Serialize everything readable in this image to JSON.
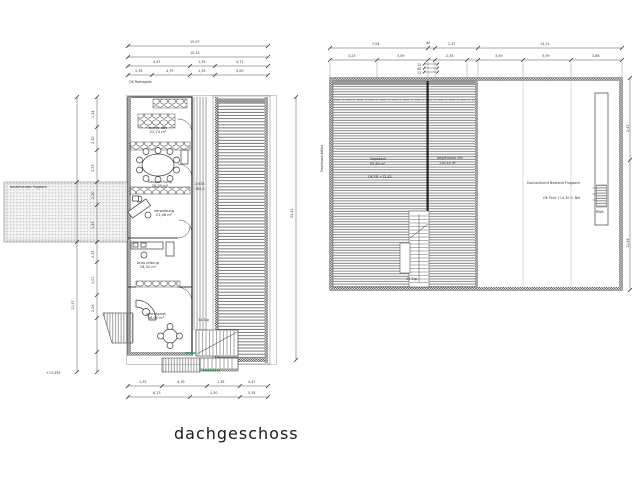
{
  "title": "dachgeschoss",
  "colors": {
    "accent_green": "#19a24a",
    "line": "#3c3c3c",
    "hatch": "#7a7a7a"
  },
  "left_plan": {
    "note_rollregal": "OK Rollregale",
    "terrace_label": "bestehendes flugdach",
    "elevation_note": "+13,455",
    "corridor_dim_a": "2,635",
    "corridor_dim_b": "100,5",
    "stair_label": "14 Stg",
    "rooms": [
      {
        "label": "archiv edv",
        "area": "22,74 m²"
      },
      {
        "label": "besprechung",
        "area": "28,05 m²"
      },
      {
        "label": "verwaltung",
        "area": "21,46 m²"
      },
      {
        "label": "büro leitung",
        "area": "18,32 m²"
      },
      {
        "label": "sekretariat",
        "area": "26,01 m²"
      }
    ],
    "dims": {
      "top_total": "15,97",
      "top_sub": "15,14",
      "top_row3": [
        "4,47",
        "1,35",
        "4,77"
      ],
      "top_row4": [
        "1,35",
        "4,79",
        "1,35",
        "5,00"
      ],
      "left_outer": "11,57",
      "left_inner": [
        "1,34",
        "2,30",
        "3,23",
        "2,30",
        "1,35",
        "2,25",
        "1,01",
        "2,26"
      ],
      "right_total": "23,41",
      "bottom_row1": [
        "1,35",
        "4,79",
        "1,35",
        "4,47"
      ],
      "bottom_row2": [
        "6,13",
        "1,50",
        "5,35"
      ]
    }
  },
  "right_plan": {
    "zone_left_label": "liegedach",
    "zone_left_area": "95,60 m²",
    "zone_left_note": "OK FB +13,45",
    "zone_mid_label": "begehbarer teil",
    "zone_mid_area": "110,45 m²",
    "note_line1": "Dachaufsicht Bestand Flugdach",
    "note_line2": "OK First +14,30 ü. NN",
    "edge_label": "Dachrand Attika",
    "skylight_label": "RWA",
    "stair_label": "14 Stg",
    "dims": {
      "top_row1": [
        "7,04",
        "2,47",
        "14,11"
      ],
      "top_row1_small": "40",
      "top_row2": [
        "3,23",
        "3,59",
        "2,35",
        "3,59",
        "3,59",
        "3,86"
      ],
      "stacked": [
        "12",
        "40",
        "12"
      ],
      "right": [
        "2,47",
        "11,64"
      ]
    }
  }
}
